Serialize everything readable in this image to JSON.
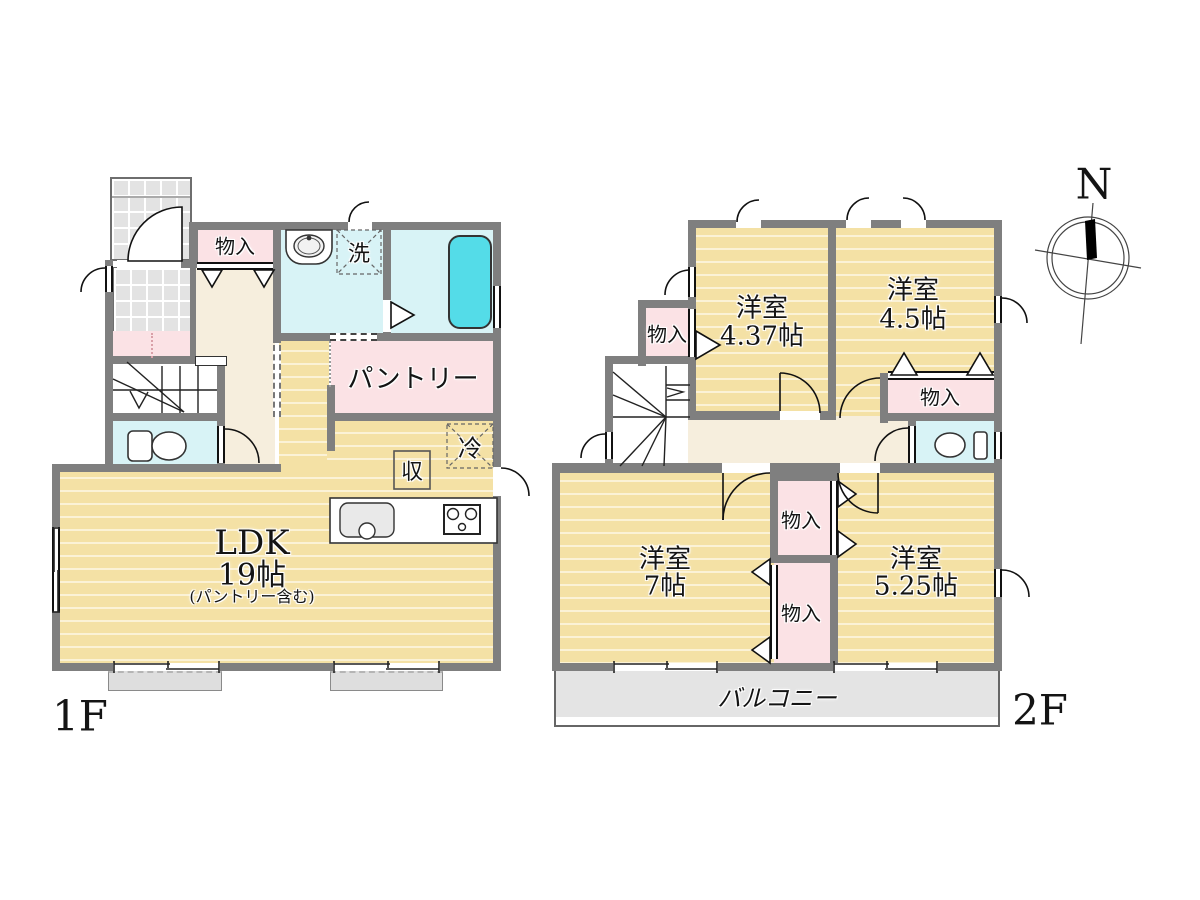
{
  "f1": {
    "label": "1F",
    "ldk": "LDK",
    "ldk_size": "19帖",
    "ldk_note": "(パントリー含む)",
    "pantry": "パントリー",
    "closet": "物入",
    "laundry": "洗",
    "fridge": "冷",
    "storage": "収"
  },
  "f2": {
    "label": "2F",
    "room1": "洋室",
    "room1_size": "4.37帖",
    "room2": "洋室",
    "room2_size": "4.5帖",
    "room3": "洋室",
    "room3_size": "7帖",
    "room4": "洋室",
    "room4_size": "5.25帖",
    "closet1": "物入",
    "closet2": "物入",
    "closet3": "物入",
    "closet4": "物入",
    "balcony": "バルコニー"
  },
  "compass": {
    "north": "N"
  },
  "colors": {
    "wall": "#7f7f7f",
    "wood": "#f4e1a5",
    "pink": "#fbe2e5",
    "cream": "#f6eedd",
    "water": "#d8f3f6",
    "tub": "#54dce8",
    "balcony": "#e4e4e4"
  }
}
